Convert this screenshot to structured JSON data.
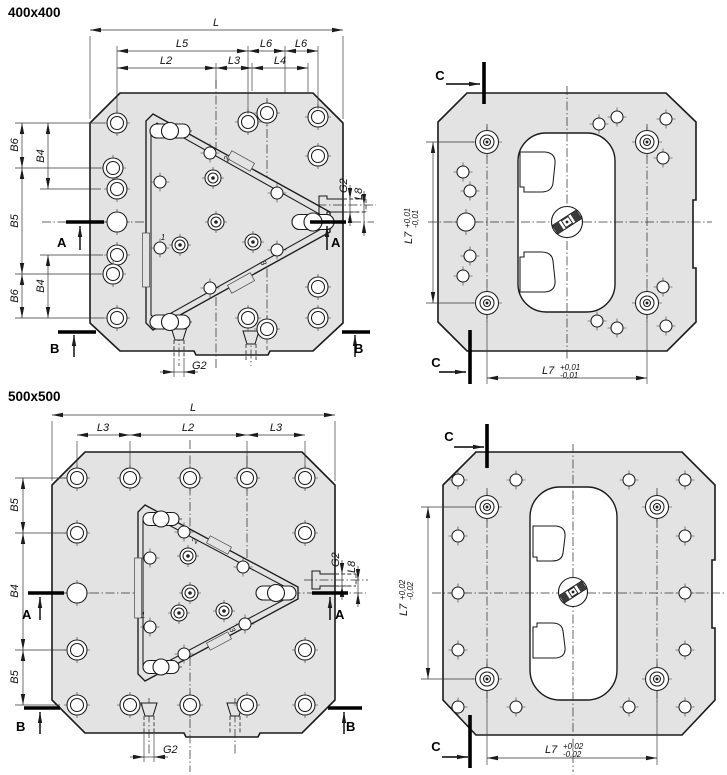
{
  "drawing": {
    "background": "#ffffff",
    "line_color": "#1b1b1b",
    "plate_fill": "#e3e3e3",
    "views": {
      "v400_front": {
        "title": "400x400",
        "dims": {
          "l": "L",
          "l5": "L5",
          "l6a": "L6",
          "l6b": "L6",
          "l2": "L2",
          "l3": "L3",
          "l4": "L4",
          "b6_top": "B6",
          "b5": "B5",
          "b6_bot": "B6",
          "b4_top": "B4",
          "b4_bot": "B4",
          "g2_right": "G2",
          "l8": "L8",
          "g2_bottom": "G2"
        },
        "sections": {
          "a": "A",
          "b": "B"
        },
        "positions": {
          "p1": "1",
          "p2": "2",
          "p3": "3"
        }
      },
      "v400_back": {
        "sections": {
          "c": "C"
        },
        "dims": {
          "l7": "L7",
          "tol_plus": "+0,01",
          "tol_minus": "-0,01"
        }
      },
      "v500_front": {
        "title": "500x500",
        "dims": {
          "l": "L",
          "l3a": "L3",
          "l2": "L2",
          "l3b": "L3",
          "b5_top": "B5",
          "b4": "B4",
          "b5_bot": "B5",
          "g2_right": "G2",
          "l8": "L8",
          "g2_bottom": "G2"
        },
        "sections": {
          "a": "A",
          "b": "B"
        },
        "positions": {
          "p1": "1",
          "p2": "2",
          "p3": "3"
        }
      },
      "v500_back": {
        "sections": {
          "c": "C"
        },
        "dims": {
          "l7": "L7",
          "tol_plus": "+0,02",
          "tol_minus": "-0,02"
        }
      }
    }
  }
}
